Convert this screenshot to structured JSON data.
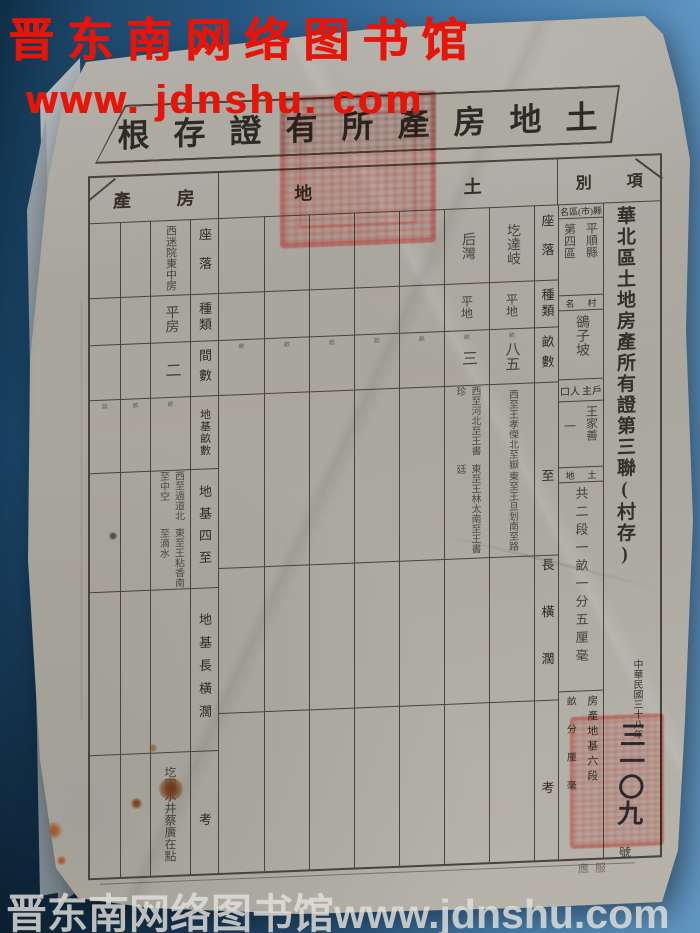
{
  "colors": {
    "bg_blue_dark": "#0f2e46",
    "bg_blue_light": "#6397c2",
    "paper": "#aaa79f",
    "ink": "#4a4438",
    "stamp_red": "#ba2016",
    "watermark_red": "#e6150a",
    "watermark_bottom": "#e2e0db"
  },
  "watermarks": {
    "top_line1": "晋东南网络图书馆",
    "top_line2": "www. jdnshu. com",
    "bottom": "晋东南网络图书馆www.jdnshu.com"
  },
  "form": {
    "title_display": "根存證有所產房地土",
    "bands": {
      "house": {
        "left_char": "產",
        "right_char": "房"
      },
      "land": {
        "left_char": "地",
        "right_char": "土"
      },
      "panel_header": {
        "left_char": "別",
        "right_char": "項"
      }
    },
    "land": {
      "labels": [
        "座落",
        "種類",
        "畝數",
        "四至",
        "長橫濶",
        "備考"
      ],
      "unit_char": "畝",
      "entries": [
        {
          "loc": "圪達岐",
          "type": "平地",
          "area": "八五",
          "bounds_east_south": "東至王旦划南至路",
          "bounds_west_north": "西至王孝傑北至嶽"
        },
        {
          "loc": "后灣",
          "type": "平地",
          "area": "三",
          "bounds_east_south": "東至王林太南至王書廷",
          "bounds_west_north": "西至河北至王書珍"
        }
      ]
    },
    "house": {
      "labels": [
        "座落",
        "種類",
        "間數",
        "地基畝數",
        "地基四至",
        "地基長橫濶",
        "備考"
      ],
      "unit_char": "畝",
      "entry": {
        "loc": "西迷院東中房",
        "type": "平房",
        "rooms": "二",
        "bounds_east_south": "東至王粘香南至滴水",
        "bounds_west_north": "西至過道北至中空",
        "note": "圪園水井蔡廣在點"
      }
    },
    "panel": {
      "region_label_display": "名區(市)縣",
      "region_value_right": "平順縣",
      "region_value_left": "第四區",
      "village_label_left": "名",
      "village_label_right": "村",
      "village_value": "鵒子坡",
      "owner_label_left": "口人",
      "owner_label_right": "主戶",
      "owner_value": "王家善",
      "population_value": "一",
      "land_label_left": "地",
      "land_label_right": "土",
      "land_total": "共二段一畝一分五厘毫",
      "house_base_right": "房產地基六段",
      "house_base_left": "畝分厘毫"
    },
    "margin": {
      "main_title": "華北區土地房產所有證第三聯(村存)",
      "date_line": "中華民國三十八年",
      "serial_number": "三一〇九",
      "serial_unit": "號",
      "bottom_faint": "應服"
    }
  }
}
